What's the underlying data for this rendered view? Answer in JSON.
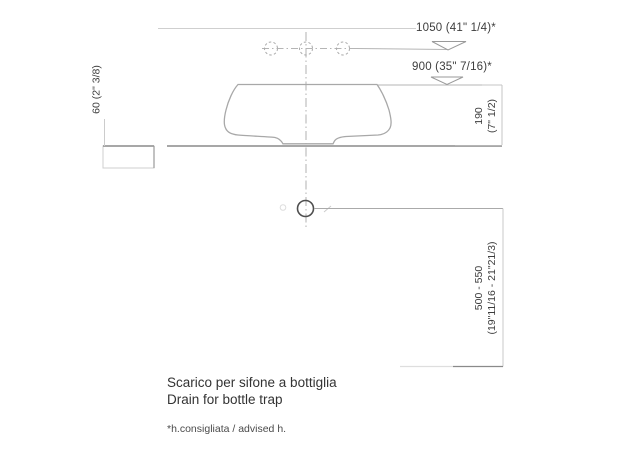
{
  "drawing": {
    "type": "technical-installation-drawing",
    "subject": "washbasin side profile with drain height specification",
    "dimensions": {
      "faucet_line_height": "1050 (41\" 1/4)*",
      "rim_line_height": "900 (35\" 7/16)*",
      "counter_thickness": "60 (2\" 3/8)",
      "basin_height_mm": "190",
      "basin_height_in": "(7\" 1/2)",
      "drain_height_mm": "500 - 550",
      "drain_height_in": "(19\"11/16 - 21\"21/3)"
    },
    "captions": {
      "title_it": "Scarico per sifone a bottiglia",
      "title_en": "Drain for bottle trap",
      "footnote": "*h.consigliata / advised h."
    },
    "colors": {
      "background": "#ffffff",
      "line_light": "#c4c4c4",
      "line_mid": "#a8a8a8",
      "line_dark": "#8a8a8a",
      "drain_circle": "#4f4f4f",
      "text": "#3d3d3d"
    }
  }
}
